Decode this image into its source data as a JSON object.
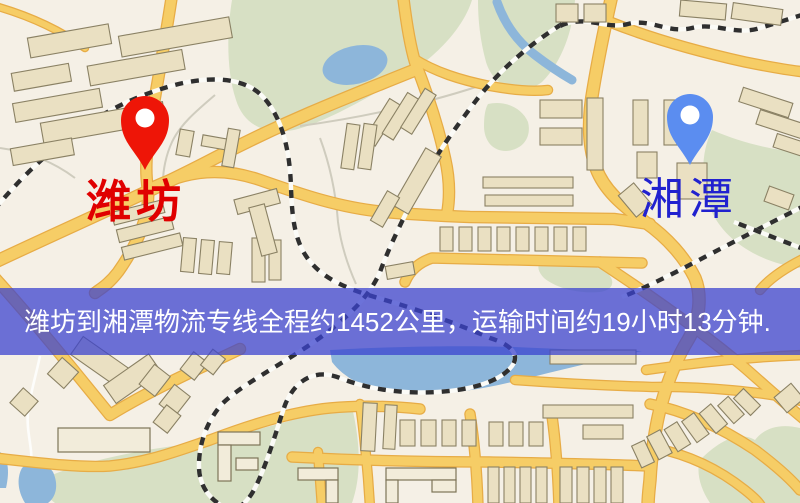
{
  "map": {
    "markers": {
      "origin": {
        "label": "潍坊",
        "label_color": "#e00000",
        "pin_color": "#ee1507"
      },
      "destination": {
        "label": "湘潭",
        "label_color": "#2121cf",
        "pin_color": "#5b8df0"
      }
    },
    "banner": {
      "text": "潍坊到湘潭物流专线全程约1452公里，运输时间约19小时13分钟.",
      "bg_color": "#3a42cf",
      "text_color": "#ffffff"
    },
    "palette": {
      "background": "#f5f0e6",
      "road_fill": "#f6cd66",
      "road_edge": "#e7ac46",
      "park_green": "#d7e0c4",
      "water_blue": "#8db6da",
      "building_fill": "#eae0c2",
      "railway_dark": "#2f2f2f"
    }
  }
}
